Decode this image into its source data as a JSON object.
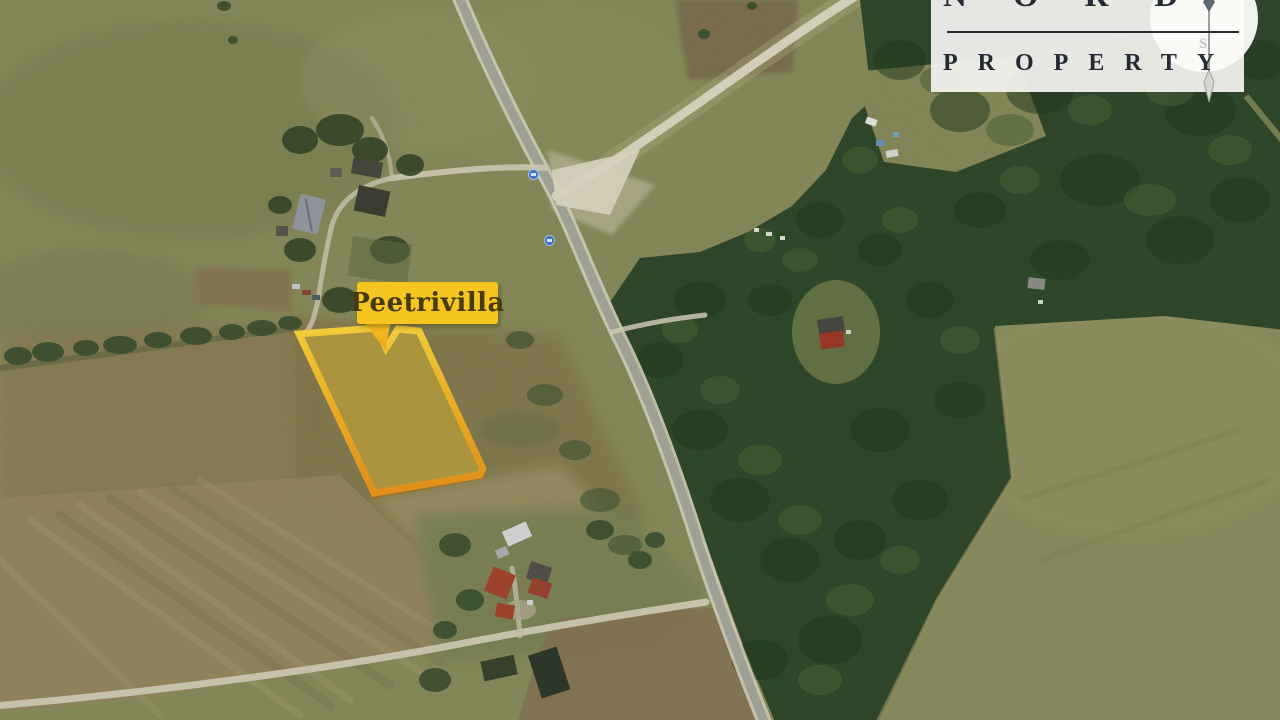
{
  "map": {
    "kind": "aerial-satellite-photo",
    "parcel_label": "Peetrivilla",
    "palette": {
      "parcel_fill": "#FFD22A",
      "parcel_border_top": "#FFDA3E",
      "parcel_border_mid": "#F5B124",
      "parcel_border_bottom": "#EC951B",
      "parcel_shadow": "#AD7414",
      "label_background": "#F6C520",
      "label_text": "#463A0D",
      "field_olive": "#8B8E5D",
      "field_tan": "#978A61",
      "forest_green": "#314A2D",
      "road_asphalt": "#A7A99E",
      "road_casing": "#D8D5C2",
      "road_gravel": "#E2DDC8",
      "dirt_road": "#D6D0BA",
      "route_marker_blue": "#3A72C4"
    }
  },
  "logo": {
    "line1": "NORD",
    "line2": "PROPERTY",
    "compass_south": "S",
    "palette": {
      "text": "#242B33",
      "background": "rgba(244,243,240,0.93)",
      "compass_circle": "#FBFBF8",
      "needle_gray": "#5F6870",
      "south_letter": "#C2C5C6"
    }
  }
}
